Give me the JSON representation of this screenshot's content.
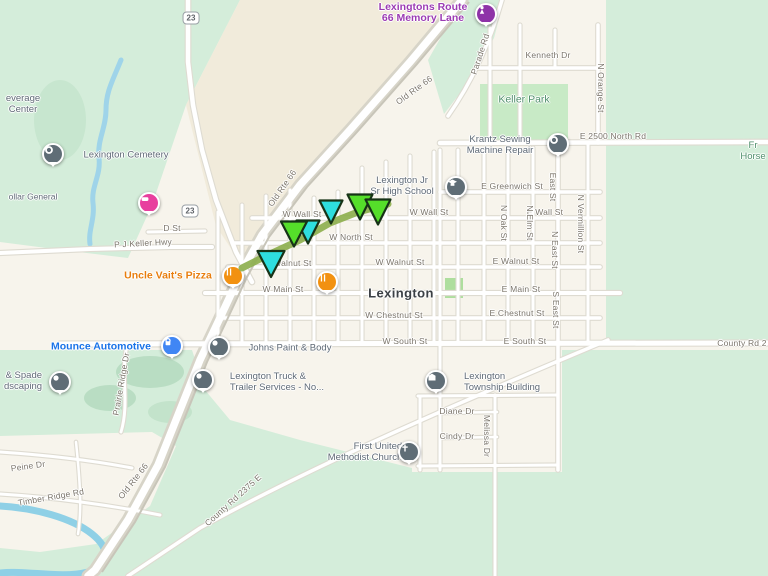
{
  "town": {
    "text": "Lexington",
    "x": 401,
    "y": 293
  },
  "colors": {
    "land": "#f7f4ec",
    "land_beige": "#f1ebdb",
    "green": "#d4edda",
    "park_green": "#c8eac6",
    "water": "#9fd4e9",
    "street_text": "#7b756b",
    "poi_gray": "#5f6a76",
    "poi_orange": "#e87d0d",
    "poi_blue": "#1a73e8",
    "poi_purple": "#9b3bb3",
    "area_green_text": "#4f8f6b",
    "marker_slate": "#5f6d76",
    "marker_orange": "#f29111",
    "marker_blue": "#4086f4",
    "marker_purple": "#8e33a8",
    "marker_pink": "#e83f9e",
    "route_line": "#8cae4b",
    "arrow_green": "#55de2a",
    "arrow_cyan": "#2edede",
    "arrow_outline": "#173317"
  },
  "shields": [
    {
      "label": "23",
      "x": 191,
      "y": 18
    },
    {
      "label": "23",
      "x": 190,
      "y": 211
    }
  ],
  "streets": [
    {
      "name": "kenneth-dr",
      "text": "Kenneth Dr",
      "x": 548,
      "y": 55,
      "rot": 0
    },
    {
      "name": "n-orange-st",
      "text": "N Orange St",
      "x": 601,
      "y": 88,
      "rot": 90
    },
    {
      "name": "parade-rd",
      "text": "Parade Rd",
      "x": 480,
      "y": 54,
      "rot": -72
    },
    {
      "name": "e-2500-north-rd",
      "text": "E 2500 North Rd",
      "x": 613,
      "y": 136,
      "rot": 0
    },
    {
      "name": "old-rte-66-top",
      "text": "Old Rte 66",
      "x": 414,
      "y": 90,
      "rot": -36
    },
    {
      "name": "old-rte-66-mid",
      "text": "Old Rte 66",
      "x": 282,
      "y": 188,
      "rot": -55
    },
    {
      "name": "old-rte-66-bottom",
      "text": "Old Rte 66",
      "x": 133,
      "y": 481,
      "rot": -52
    },
    {
      "name": "d-st",
      "text": "D St",
      "x": 172,
      "y": 228,
      "rot": 0
    },
    {
      "name": "p-j-keller-hwy",
      "text": "P J Keller Hwy",
      "x": 143,
      "y": 243,
      "rot": -3
    },
    {
      "name": "e-greenwich-st",
      "text": "E Greenwich St",
      "x": 512,
      "y": 186,
      "rot": 0
    },
    {
      "name": "w-wall-st-west",
      "text": "W Wall St",
      "x": 302,
      "y": 214,
      "rot": 0
    },
    {
      "name": "w-wall-st",
      "text": "W Wall St",
      "x": 429,
      "y": 212,
      "rot": 0
    },
    {
      "name": "e-wall-st",
      "text": "E Wall St",
      "x": 545,
      "y": 212,
      "rot": 0
    },
    {
      "name": "w-north-st",
      "text": "W North St",
      "x": 351,
      "y": 237,
      "rot": 0
    },
    {
      "name": "w-walnut-st-west",
      "text": "W Walnut St",
      "x": 287,
      "y": 263,
      "rot": 0
    },
    {
      "name": "w-walnut-st",
      "text": "W Walnut St",
      "x": 400,
      "y": 262,
      "rot": 0
    },
    {
      "name": "e-walnut-st",
      "text": "E Walnut St",
      "x": 516,
      "y": 261,
      "rot": 0
    },
    {
      "name": "w-main-st",
      "text": "W Main St",
      "x": 283,
      "y": 289,
      "rot": 0
    },
    {
      "name": "e-main-st",
      "text": "E Main St",
      "x": 521,
      "y": 289,
      "rot": 0
    },
    {
      "name": "w-chestnut-st",
      "text": "W Chestnut St",
      "x": 394,
      "y": 315,
      "rot": 0
    },
    {
      "name": "e-chestnut-st",
      "text": "E Chestnut St",
      "x": 517,
      "y": 313,
      "rot": 0
    },
    {
      "name": "w-south-st",
      "text": "W South St",
      "x": 405,
      "y": 341,
      "rot": 0
    },
    {
      "name": "e-south-st",
      "text": "E South St",
      "x": 525,
      "y": 341,
      "rot": 0
    },
    {
      "name": "county-rd-2",
      "text": "County Rd 2",
      "x": 742,
      "y": 343,
      "rot": 0
    },
    {
      "name": "east-st",
      "text": "East St",
      "x": 553,
      "y": 187,
      "rot": 90
    },
    {
      "name": "n-oak-st",
      "text": "N Oak St",
      "x": 504,
      "y": 223,
      "rot": 90
    },
    {
      "name": "n-elm-st",
      "text": "N Elm St",
      "x": 530,
      "y": 223,
      "rot": 90
    },
    {
      "name": "n-east-st",
      "text": "N East St",
      "x": 555,
      "y": 250,
      "rot": 90
    },
    {
      "name": "n-vermillion-st",
      "text": "N Vermillion St",
      "x": 581,
      "y": 224,
      "rot": 90
    },
    {
      "name": "s-east-st",
      "text": "S East St",
      "x": 556,
      "y": 310,
      "rot": 90
    },
    {
      "name": "diane-dr",
      "text": "Diane Dr",
      "x": 457,
      "y": 411,
      "rot": 0
    },
    {
      "name": "cindy-dr",
      "text": "Cindy Dr",
      "x": 457,
      "y": 436,
      "rot": 0
    },
    {
      "name": "melissa-dr",
      "text": "Melissa Dr",
      "x": 487,
      "y": 436,
      "rot": 90
    },
    {
      "name": "prairie-ridge-dr",
      "text": "Prairie Ridge Dr",
      "x": 121,
      "y": 384,
      "rot": -80
    },
    {
      "name": "peine-dr",
      "text": "Peine Dr",
      "x": 28,
      "y": 466,
      "rot": -8
    },
    {
      "name": "timber-ridge-rd",
      "text": "Timber Ridge Rd",
      "x": 51,
      "y": 497,
      "rot": -10
    },
    {
      "name": "county-rd-2375-e",
      "text": "County Rd 2375 E",
      "x": 233,
      "y": 500,
      "rot": -42
    }
  ],
  "pois": [
    {
      "name": "beverage-center",
      "lines": [
        "everage",
        "Center"
      ],
      "x": 23,
      "y": 104,
      "style": "gray",
      "align": "center",
      "size": "md"
    },
    {
      "name": "lexington-cemetery",
      "lines": [
        "Lexington Cemetery"
      ],
      "x": 126,
      "y": 155,
      "style": "gray",
      "align": "left",
      "size": "md"
    },
    {
      "name": "dollar-general",
      "lines": [
        "ollar General"
      ],
      "x": 33,
      "y": 197,
      "style": "gray",
      "align": "left",
      "size": "sm"
    },
    {
      "name": "krantz-sewing-machine-repair",
      "lines": [
        "Krantz Sewing",
        "Machine Repair"
      ],
      "x": 500,
      "y": 145,
      "style": "gray",
      "align": "center",
      "size": "md"
    },
    {
      "name": "lexington-jr-sr-high-school",
      "lines": [
        "Lexington Jr",
        "Sr High School"
      ],
      "x": 402,
      "y": 186,
      "style": "gray",
      "align": "center",
      "size": "md"
    },
    {
      "name": "uncle-vaits-pizza",
      "lines": [
        "Uncle Vait's Pizza"
      ],
      "x": 168,
      "y": 276,
      "style": "orange",
      "align": "center",
      "size": "lg"
    },
    {
      "name": "mounce-automotive",
      "lines": [
        "Mounce Automotive"
      ],
      "x": 101,
      "y": 347,
      "style": "blue",
      "align": "center",
      "size": "lg"
    },
    {
      "name": "spade-landscaping",
      "lines": [
        "& Spade",
        "dscaping"
      ],
      "x": 23,
      "y": 381,
      "style": "gray",
      "align": "right",
      "size": "md"
    },
    {
      "name": "johns-paint-and-body",
      "lines": [
        "Johns Paint & Body"
      ],
      "x": 290,
      "y": 348,
      "style": "gray",
      "align": "left",
      "size": "md"
    },
    {
      "name": "lexington-truck-trailer-services",
      "lines": [
        "Lexington Truck &",
        "Trailer Services - No..."
      ],
      "x": 277,
      "y": 382,
      "style": "gray",
      "align": "left",
      "size": "md"
    },
    {
      "name": "lexington-township-building",
      "lines": [
        "Lexington",
        "Township Building"
      ],
      "x": 502,
      "y": 382,
      "style": "gray",
      "align": "left",
      "size": "md"
    },
    {
      "name": "first-united-methodist-church",
      "lines": [
        "First United",
        "Methodist Church"
      ],
      "x": 365,
      "y": 452,
      "style": "gray",
      "align": "right",
      "size": "md"
    },
    {
      "name": "lexingtons-route-66-memory-lane",
      "lines": [
        "Lexingtons Route",
        "66 Memory Lane"
      ],
      "x": 423,
      "y": 13,
      "style": "purple",
      "align": "center",
      "size": "lg"
    },
    {
      "name": "keller-park",
      "lines": [
        "Keller Park"
      ],
      "x": 524,
      "y": 100,
      "style": "green",
      "align": "center",
      "size": "lg"
    },
    {
      "name": "horse-area",
      "lines": [
        "Fr",
        "Horse"
      ],
      "x": 753,
      "y": 151,
      "style": "green",
      "align": "center",
      "size": "md"
    }
  ],
  "markers": [
    {
      "name": "memory-lane-marker",
      "glyph": "statue",
      "color": "#8e33a8",
      "x": 486,
      "y": 14
    },
    {
      "name": "cemetery-marker",
      "glyph": "ring",
      "color": "#5f6d76",
      "x": 53,
      "y": 154
    },
    {
      "name": "dollar-general-marker",
      "glyph": "dg",
      "color": "#e83f9e",
      "x": 149,
      "y": 203
    },
    {
      "name": "krantz-marker",
      "glyph": "ring",
      "color": "#5f6d76",
      "x": 558,
      "y": 144
    },
    {
      "name": "school-marker",
      "glyph": "school",
      "color": "#5f6d76",
      "x": 456,
      "y": 187
    },
    {
      "name": "pizza-marker",
      "glyph": "restaurant",
      "color": "#f29111",
      "x": 233,
      "y": 276
    },
    {
      "name": "restaurant-marker",
      "glyph": "restaurant",
      "color": "#f29111",
      "x": 327,
      "y": 282
    },
    {
      "name": "mounce-marker",
      "glyph": "lock",
      "color": "#4086f4",
      "x": 172,
      "y": 346
    },
    {
      "name": "landscaping-marker",
      "glyph": "dot",
      "color": "#5f6d76",
      "x": 60,
      "y": 382
    },
    {
      "name": "johns-marker",
      "glyph": "dot",
      "color": "#5f6d76",
      "x": 219,
      "y": 347
    },
    {
      "name": "truck-marker",
      "glyph": "dot",
      "color": "#5f6d76",
      "x": 203,
      "y": 380
    },
    {
      "name": "township-marker",
      "glyph": "building",
      "color": "#5f6d76",
      "x": 436,
      "y": 381
    },
    {
      "name": "church-marker",
      "glyph": "church",
      "color": "#5f6d76",
      "x": 409,
      "y": 452
    }
  ],
  "annotation": {
    "route_points": [
      [
        242,
        268
      ],
      [
        270,
        254
      ],
      [
        300,
        240
      ],
      [
        330,
        223
      ],
      [
        358,
        212
      ],
      [
        388,
        204
      ]
    ],
    "arrows": [
      {
        "color": "green",
        "x": 360,
        "y": 207,
        "w": 25,
        "h": 25
      },
      {
        "color": "green",
        "x": 378,
        "y": 212,
        "w": 25,
        "h": 25
      },
      {
        "color": "cyan",
        "x": 331,
        "y": 212,
        "w": 23,
        "h": 23
      },
      {
        "color": "cyan",
        "x": 308,
        "y": 232,
        "w": 23,
        "h": 23
      },
      {
        "color": "green",
        "x": 294,
        "y": 234,
        "w": 26,
        "h": 25
      },
      {
        "color": "cyan",
        "x": 271,
        "y": 264,
        "w": 27,
        "h": 26
      }
    ]
  }
}
